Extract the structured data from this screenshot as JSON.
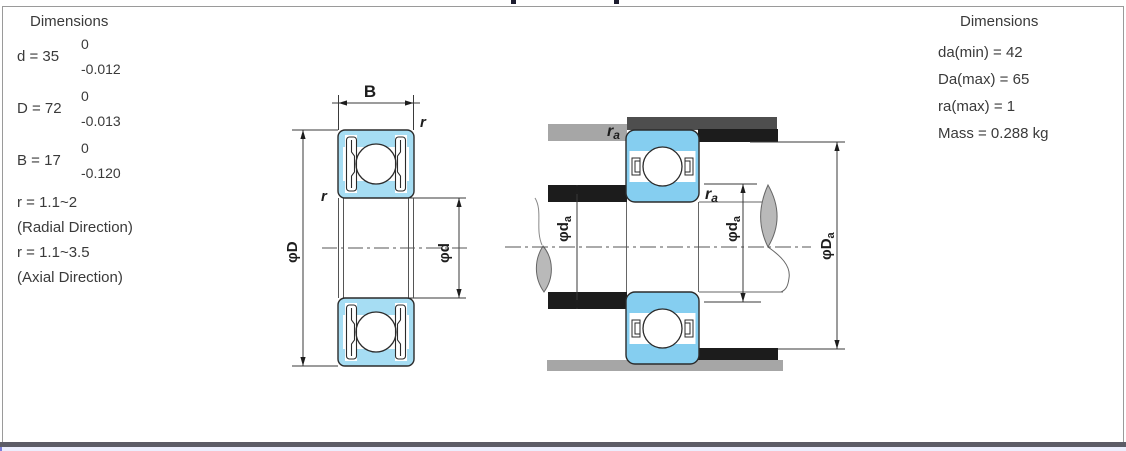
{
  "panel_left": {
    "title": "Dimensions",
    "tolerances": [
      {
        "label": "d = 35",
        "upper": "0",
        "lower": "-0.012"
      },
      {
        "label": "D = 72",
        "upper": "0",
        "lower": "-0.013"
      },
      {
        "label": "B = 17",
        "upper": "0",
        "lower": "-0.120"
      }
    ],
    "notes": [
      "r = 1.1~2",
      "(Radial Direction)",
      "r = 1.1~3.5",
      "(Axial Direction)"
    ]
  },
  "panel_right": {
    "title": "Dimensions",
    "items": [
      "da(min) = 42",
      "Da(max) = 65",
      "ra(max) = 1",
      "Mass = 0.288 kg"
    ]
  },
  "diagram_left": {
    "width_label": "B",
    "corner_radius_top": "r",
    "corner_radius_side": "r",
    "outer_diameter": "φD",
    "bore_diameter": "φd"
  },
  "diagram_right": {
    "fillet_top": {
      "main": "r",
      "sub": "a"
    },
    "fillet_mid": {
      "main": "r",
      "sub": "a"
    },
    "shoulder_left": {
      "main": "φd",
      "sub": "a"
    },
    "shoulder_mid": {
      "main": "φd",
      "sub": "a"
    },
    "housing_shoulder": {
      "main": "φD",
      "sub": "a"
    }
  },
  "colors": {
    "bearing_fill_left": "#A6DDF3",
    "bearing_fill_right": "#85CEF0",
    "housing_gray": "#A6A6A6",
    "housing_dark_gray": "#4E4E4E",
    "shoulder_black": "#1C1C1C",
    "outline": "#2B2B2B",
    "footer_rule": "#5C5C66",
    "footer_strip": "#ECEEFD"
  }
}
